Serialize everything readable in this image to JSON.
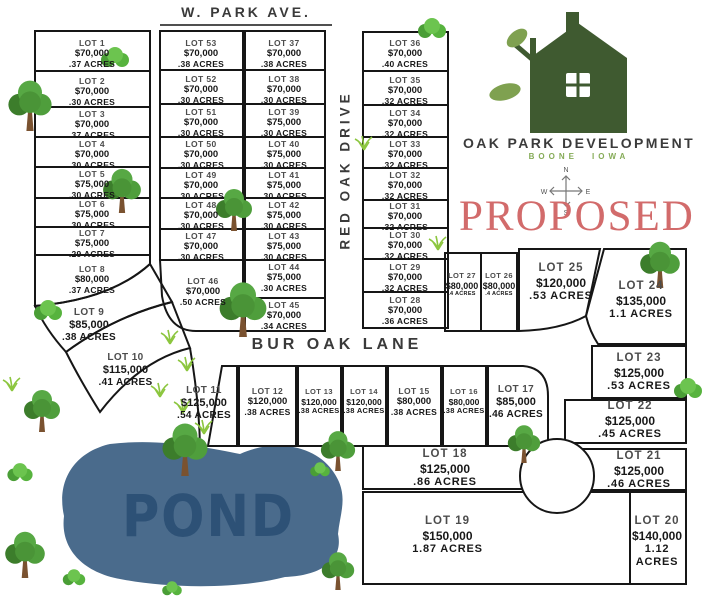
{
  "streets": {
    "w_park_ave": "W. PARK AVE.",
    "red_oak_drive": "RED OAK DRIVE",
    "bur_oak_lane": "BUR OAK LANE"
  },
  "logo": {
    "name": "OAK PARK DEVELOPMENT",
    "city": "BOONE",
    "state": "IOWA"
  },
  "status_stamp": "PROPOSED",
  "compass": {
    "n": "N",
    "e": "E",
    "s": "S",
    "w": "W"
  },
  "pond": {
    "label": "POND"
  },
  "colors": {
    "proposed_red": "#d26b6b",
    "logo_green": "#3f5a30",
    "leaf_green": "#7fa150",
    "location_green": "#85ab57",
    "pond_blue": "#4a6b8c",
    "line_black": "#161616"
  },
  "lots": {
    "1": {
      "label": "LOT 1",
      "price": "$70,000",
      "acres": ".37 ACRES"
    },
    "2": {
      "label": "LOT 2",
      "price": "$70,000",
      "acres": ".30 ACRES"
    },
    "3": {
      "label": "LOT 3",
      "price": "$70,000",
      "acres": ".37 ACRES"
    },
    "4": {
      "label": "LOT 4",
      "price": "$70,000",
      "acres": ".30 ACRES"
    },
    "5": {
      "label": "LOT 5",
      "price": "$75,000",
      "acres": ".30 ACRES"
    },
    "6": {
      "label": "LOT 6",
      "price": "$75,000",
      "acres": ".30 ACRES"
    },
    "7": {
      "label": "LOT 7",
      "price": "$75,000",
      "acres": ".29 ACRES"
    },
    "8": {
      "label": "LOT 8",
      "price": "$80,000",
      "acres": ".37 ACRES"
    },
    "9": {
      "label": "LOT 9",
      "price": "$85,000",
      "acres": ".38 ACRES"
    },
    "10": {
      "label": "LOT 10",
      "price": "$115,000",
      "acres": ".41 ACRES"
    },
    "11": {
      "label": "LOT 11",
      "price": "$125,000",
      "acres": ".54 ACRES"
    },
    "12": {
      "label": "LOT 12",
      "price": "$120,000",
      "acres": ".38 ACRES"
    },
    "13": {
      "label": "LOT 13",
      "price": "$120,000",
      "acres": ".38 ACRES"
    },
    "14": {
      "label": "LOT 14",
      "price": "$120,000",
      "acres": ".38 ACRES"
    },
    "15": {
      "label": "LOT 15",
      "price": "$80,000",
      "acres": ".38 ACRES"
    },
    "16": {
      "label": "LOT 16",
      "price": "$80,000",
      "acres": ".38 ACRES"
    },
    "17": {
      "label": "LOT 17",
      "price": "$85,000",
      "acres": ".46 ACRES"
    },
    "18": {
      "label": "LOT 18",
      "price": "$125,000",
      "acres": ".86 ACRES"
    },
    "19": {
      "label": "LOT 19",
      "price": "$150,000",
      "acres": "1.87 ACRES"
    },
    "20": {
      "label": "LOT 20",
      "price": "$140,000",
      "acres": "1.12 ACRES"
    },
    "21": {
      "label": "LOT 21",
      "price": "$125,000",
      "acres": ".46 ACRES"
    },
    "22": {
      "label": "LOT 22",
      "price": "$125,000",
      "acres": ".45 ACRES"
    },
    "23": {
      "label": "LOT 23",
      "price": "$125,000",
      "acres": ".53 ACRES"
    },
    "24": {
      "label": "LOT 24",
      "price": "$135,000",
      "acres": "1.1 ACRES"
    },
    "25": {
      "label": "LOT 25",
      "price": "$120,000",
      "acres": ".53 ACRES"
    },
    "26": {
      "label": "LOT 26",
      "price": "$80,000",
      "acres": ".4 ACRES"
    },
    "27": {
      "label": "LOT 27",
      "price": "$80,000",
      "acres": ".4 ACRES"
    },
    "28": {
      "label": "LOT 28",
      "price": "$70,000",
      "acres": ".36 ACRES"
    },
    "29": {
      "label": "LOT 29",
      "price": "$70,000",
      "acres": ".32 ACRES"
    },
    "30": {
      "label": "LOT 30",
      "price": "$70,000",
      "acres": ".32 ACRES"
    },
    "31": {
      "label": "LOT 31",
      "price": "$70,000",
      "acres": ".32 ACRES"
    },
    "32": {
      "label": "LOT 32",
      "price": "$70,000",
      "acres": ".32 ACRES"
    },
    "33": {
      "label": "LOT 33",
      "price": "$70,000",
      "acres": ".32 ACRES"
    },
    "34": {
      "label": "LOT 34",
      "price": "$70,000",
      "acres": ".32 ACRES"
    },
    "35": {
      "label": "LOT 35",
      "price": "$70,000",
      "acres": ".32 ACRES"
    },
    "36": {
      "label": "LOT 36",
      "price": "$70,000",
      "acres": ".40 ACRES"
    },
    "37": {
      "label": "LOT 37",
      "price": "$70,000",
      "acres": ".38 ACRES"
    },
    "38": {
      "label": "LOT 38",
      "price": "$70,000",
      "acres": ".30 ACRES"
    },
    "39": {
      "label": "LOT 39",
      "price": "$75,000",
      "acres": ".30 ACRES"
    },
    "40": {
      "label": "LOT 40",
      "price": "$75,000",
      "acres": ".30 ACRES"
    },
    "41": {
      "label": "LOT 41",
      "price": "$75,000",
      "acres": ".30 ACRES"
    },
    "42": {
      "label": "LOT 42",
      "price": "$75,000",
      "acres": ".30 ACRES"
    },
    "43": {
      "label": "LOT 43",
      "price": "$75,000",
      "acres": ".30 ACRES"
    },
    "44": {
      "label": "LOT 44",
      "price": "$75,000",
      "acres": ".30 ACRES"
    },
    "45": {
      "label": "LOT 45",
      "price": "$70,000",
      "acres": ".34 ACRES"
    },
    "46": {
      "label": "LOT 46",
      "price": "$70,000",
      "acres": ".50 ACRES"
    },
    "47": {
      "label": "LOT 47",
      "price": "$70,000",
      "acres": ".30 ACRES"
    },
    "48": {
      "label": "LOT 48",
      "price": "$70,000",
      "acres": ".30 ACRES"
    },
    "49": {
      "label": "LOT 49",
      "price": "$70,000",
      "acres": ".30 ACRES"
    },
    "50": {
      "label": "LOT 50",
      "price": "$70,000",
      "acres": ".30 ACRES"
    },
    "51": {
      "label": "LOT 51",
      "price": "$70,000",
      "acres": ".30 ACRES"
    },
    "52": {
      "label": "LOT 52",
      "price": "$70,000",
      "acres": ".30 ACRES"
    },
    "53": {
      "label": "LOT 53",
      "price": "$70,000",
      "acres": ".38 ACRES"
    }
  }
}
